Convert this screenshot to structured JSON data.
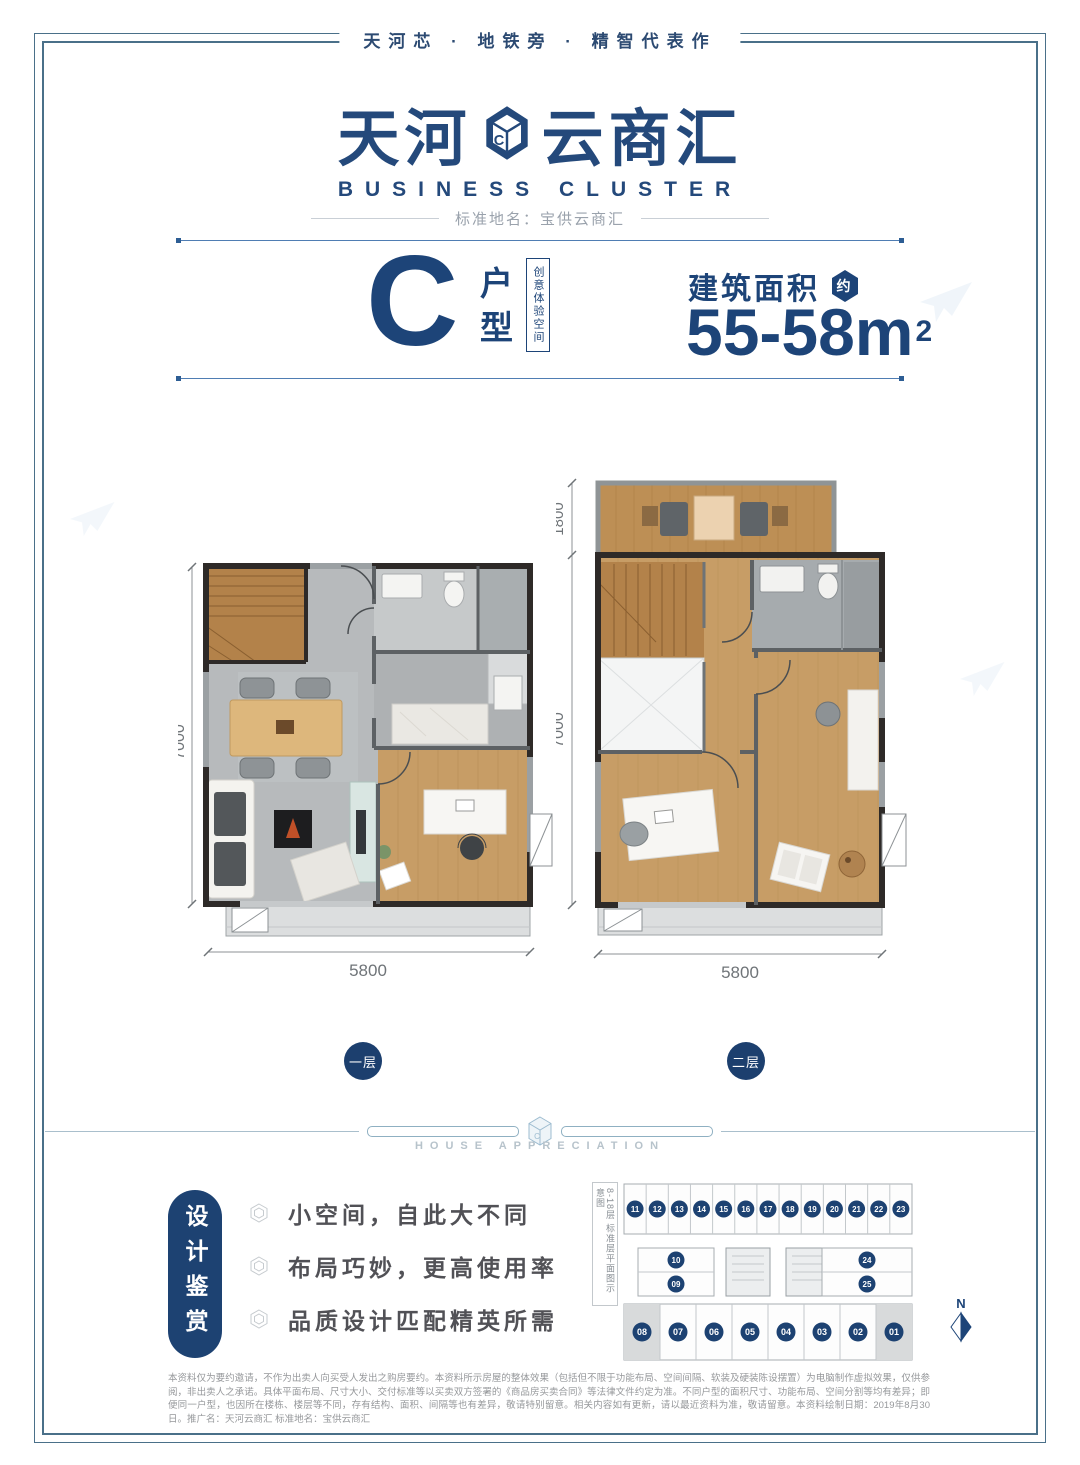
{
  "header": {
    "tagline": "天河芯 · 地铁旁 · 精智代表作"
  },
  "logo": {
    "name_left": "天河",
    "name_right": "云商汇",
    "icon_letter": "C",
    "subtitle": "BUSINESS CLUSTER",
    "standard_name": "标准地名：宝供云商汇"
  },
  "unit_info": {
    "letter": "C",
    "type_char_1": "户",
    "type_char_2": "型",
    "creative_badge": "创意体验空间",
    "area_label": "建筑面积",
    "area_approx": "约",
    "area_value": "55-58m",
    "area_exponent": "2"
  },
  "plans": [
    {
      "floor_label": "一层",
      "dim_left": "7000",
      "dim_bottom": "5800"
    },
    {
      "floor_label": "二层",
      "dim_top": "1800",
      "dim_left": "7000",
      "dim_bottom": "5800"
    }
  ],
  "divider": {
    "caption": "HOUSE APPRECIATION",
    "icon_letter": "C"
  },
  "design_review": {
    "tab_label": "设计鉴赏",
    "bullets": [
      "小空间，自此大不同",
      "布局巧妙，更高使用率",
      "品质设计匹配精英所需"
    ]
  },
  "floor_plate": {
    "side_label": "8-18层 标准层平面图示意图",
    "north_label": "N",
    "top_row": [
      "11",
      "12",
      "13",
      "14",
      "15",
      "16",
      "17",
      "18",
      "19",
      "20",
      "21",
      "22",
      "23"
    ],
    "mid_left": [
      "10",
      "09"
    ],
    "mid_right": [
      "24",
      "25"
    ],
    "bottom_row": [
      "08",
      "07",
      "06",
      "05",
      "04",
      "03",
      "02",
      "01"
    ],
    "highlighted_units": [
      "08",
      "01"
    ]
  },
  "disclaimer": "本资料仅为要约邀请，不作为出卖人向买受人发出之购房要约。本资料所示房屋的整体效果（包括但不限于功能布局、空间间隔、软装及硬装陈设摆置）为电脑制作虚拟效果，仅供参阅，非出卖人之承诺。具体平面布局、尺寸大小、交付标准等以买卖双方签署的《商品房买卖合同》等法律文件约定为准。不同户型的面积尺寸、功能布局、空间分割等均有差异；即便同一户型，也因所在楼栋、楼层等不同，存有结构、面积、间隔等也有差异，敬请特别留意。相关内容如有更新，请以最近资料为准，敬请留意。本资料绘制日期：2019年8月30日。推广名：天河云商汇 标准地名：宝供云商汇",
  "colors": {
    "primary_navy": "#1d4478",
    "badge_navy": "#1c3f6e",
    "frame_blue": "#4a7089",
    "accent_line": "#4f7db3",
    "wood": "#c79d66",
    "floor_gray": "#b7babc",
    "fine_print_gray": "#96989b"
  }
}
